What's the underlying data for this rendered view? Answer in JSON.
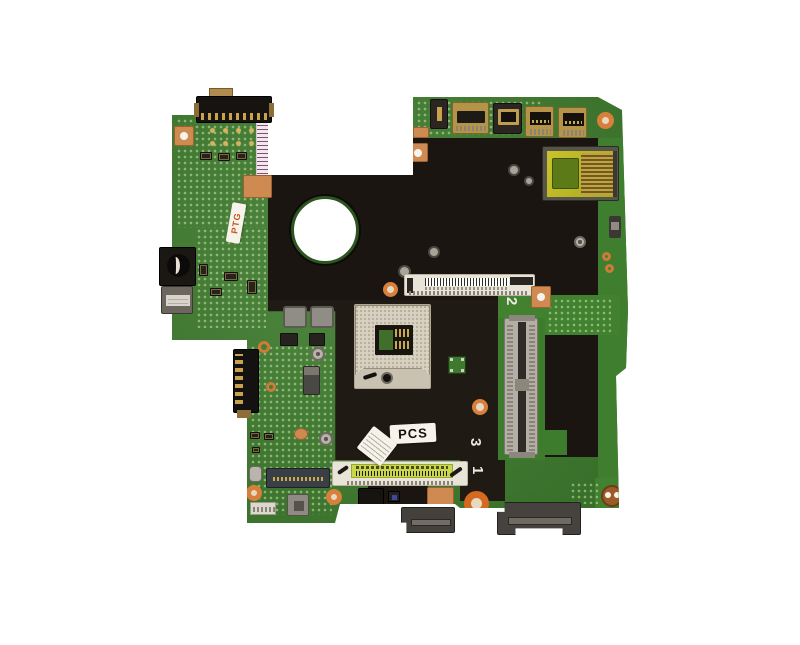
{
  "photo": {
    "subject": "green laptop motherboard on white background",
    "background_color": "#ffffff",
    "pcb_color": "#3c7b2c",
    "thermal_pad_color": "#1a1511",
    "copper_color": "#cf8a52",
    "socket_color": "#d9d2c2"
  },
  "stickers": {
    "ptg_label": "PTG",
    "pcs_label": "PCS"
  },
  "silkscreen": {
    "slot_number_1": "1",
    "slot_number_2": "2",
    "slot_number_3": "3"
  }
}
